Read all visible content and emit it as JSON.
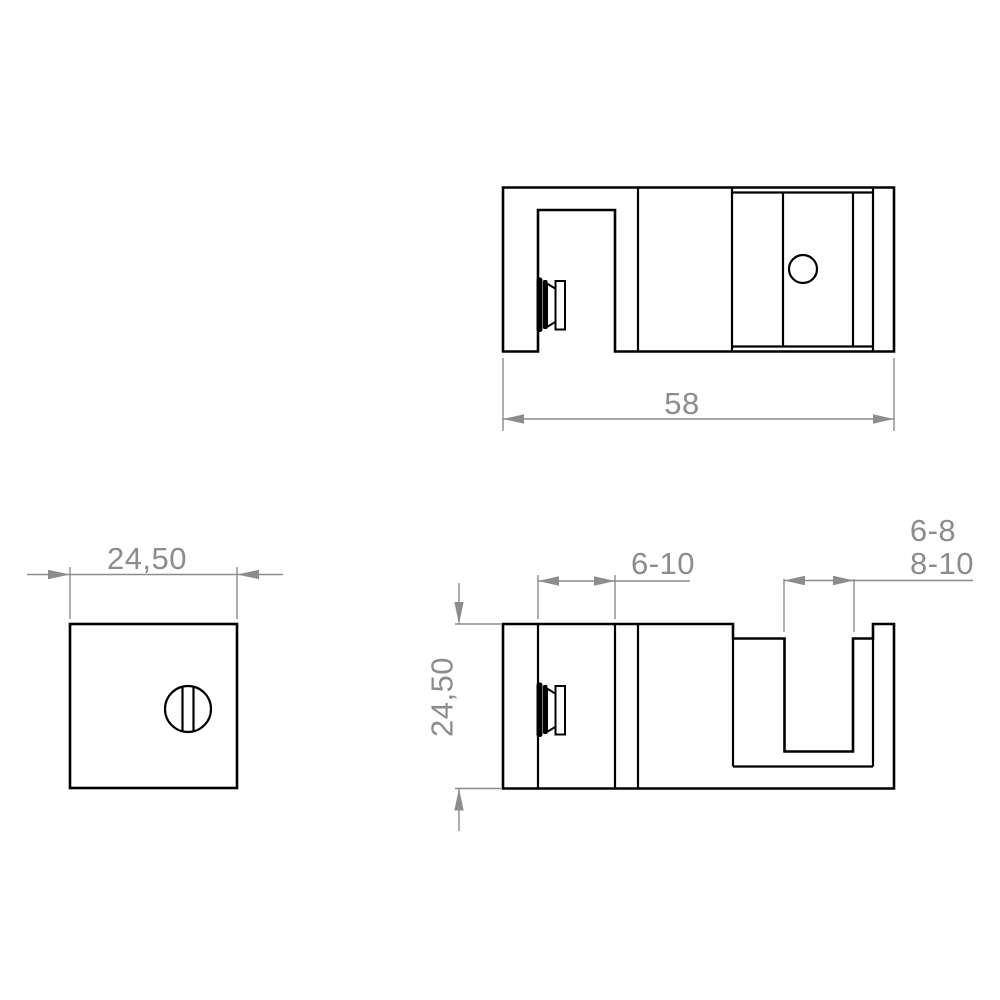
{
  "drawing": {
    "type": "technical-orthographic-views",
    "colors": {
      "part_line": "#000000",
      "dimension_line": "#8c8c8c",
      "background": "#ffffff"
    },
    "dimensions": {
      "side_overall_width": "58",
      "front_width": "24,50",
      "plan_height": "24,50",
      "plan_jaw_opening": "6-10",
      "plan_slot_range_upper": "6-8",
      "plan_slot_range_lower": "8-10"
    }
  }
}
